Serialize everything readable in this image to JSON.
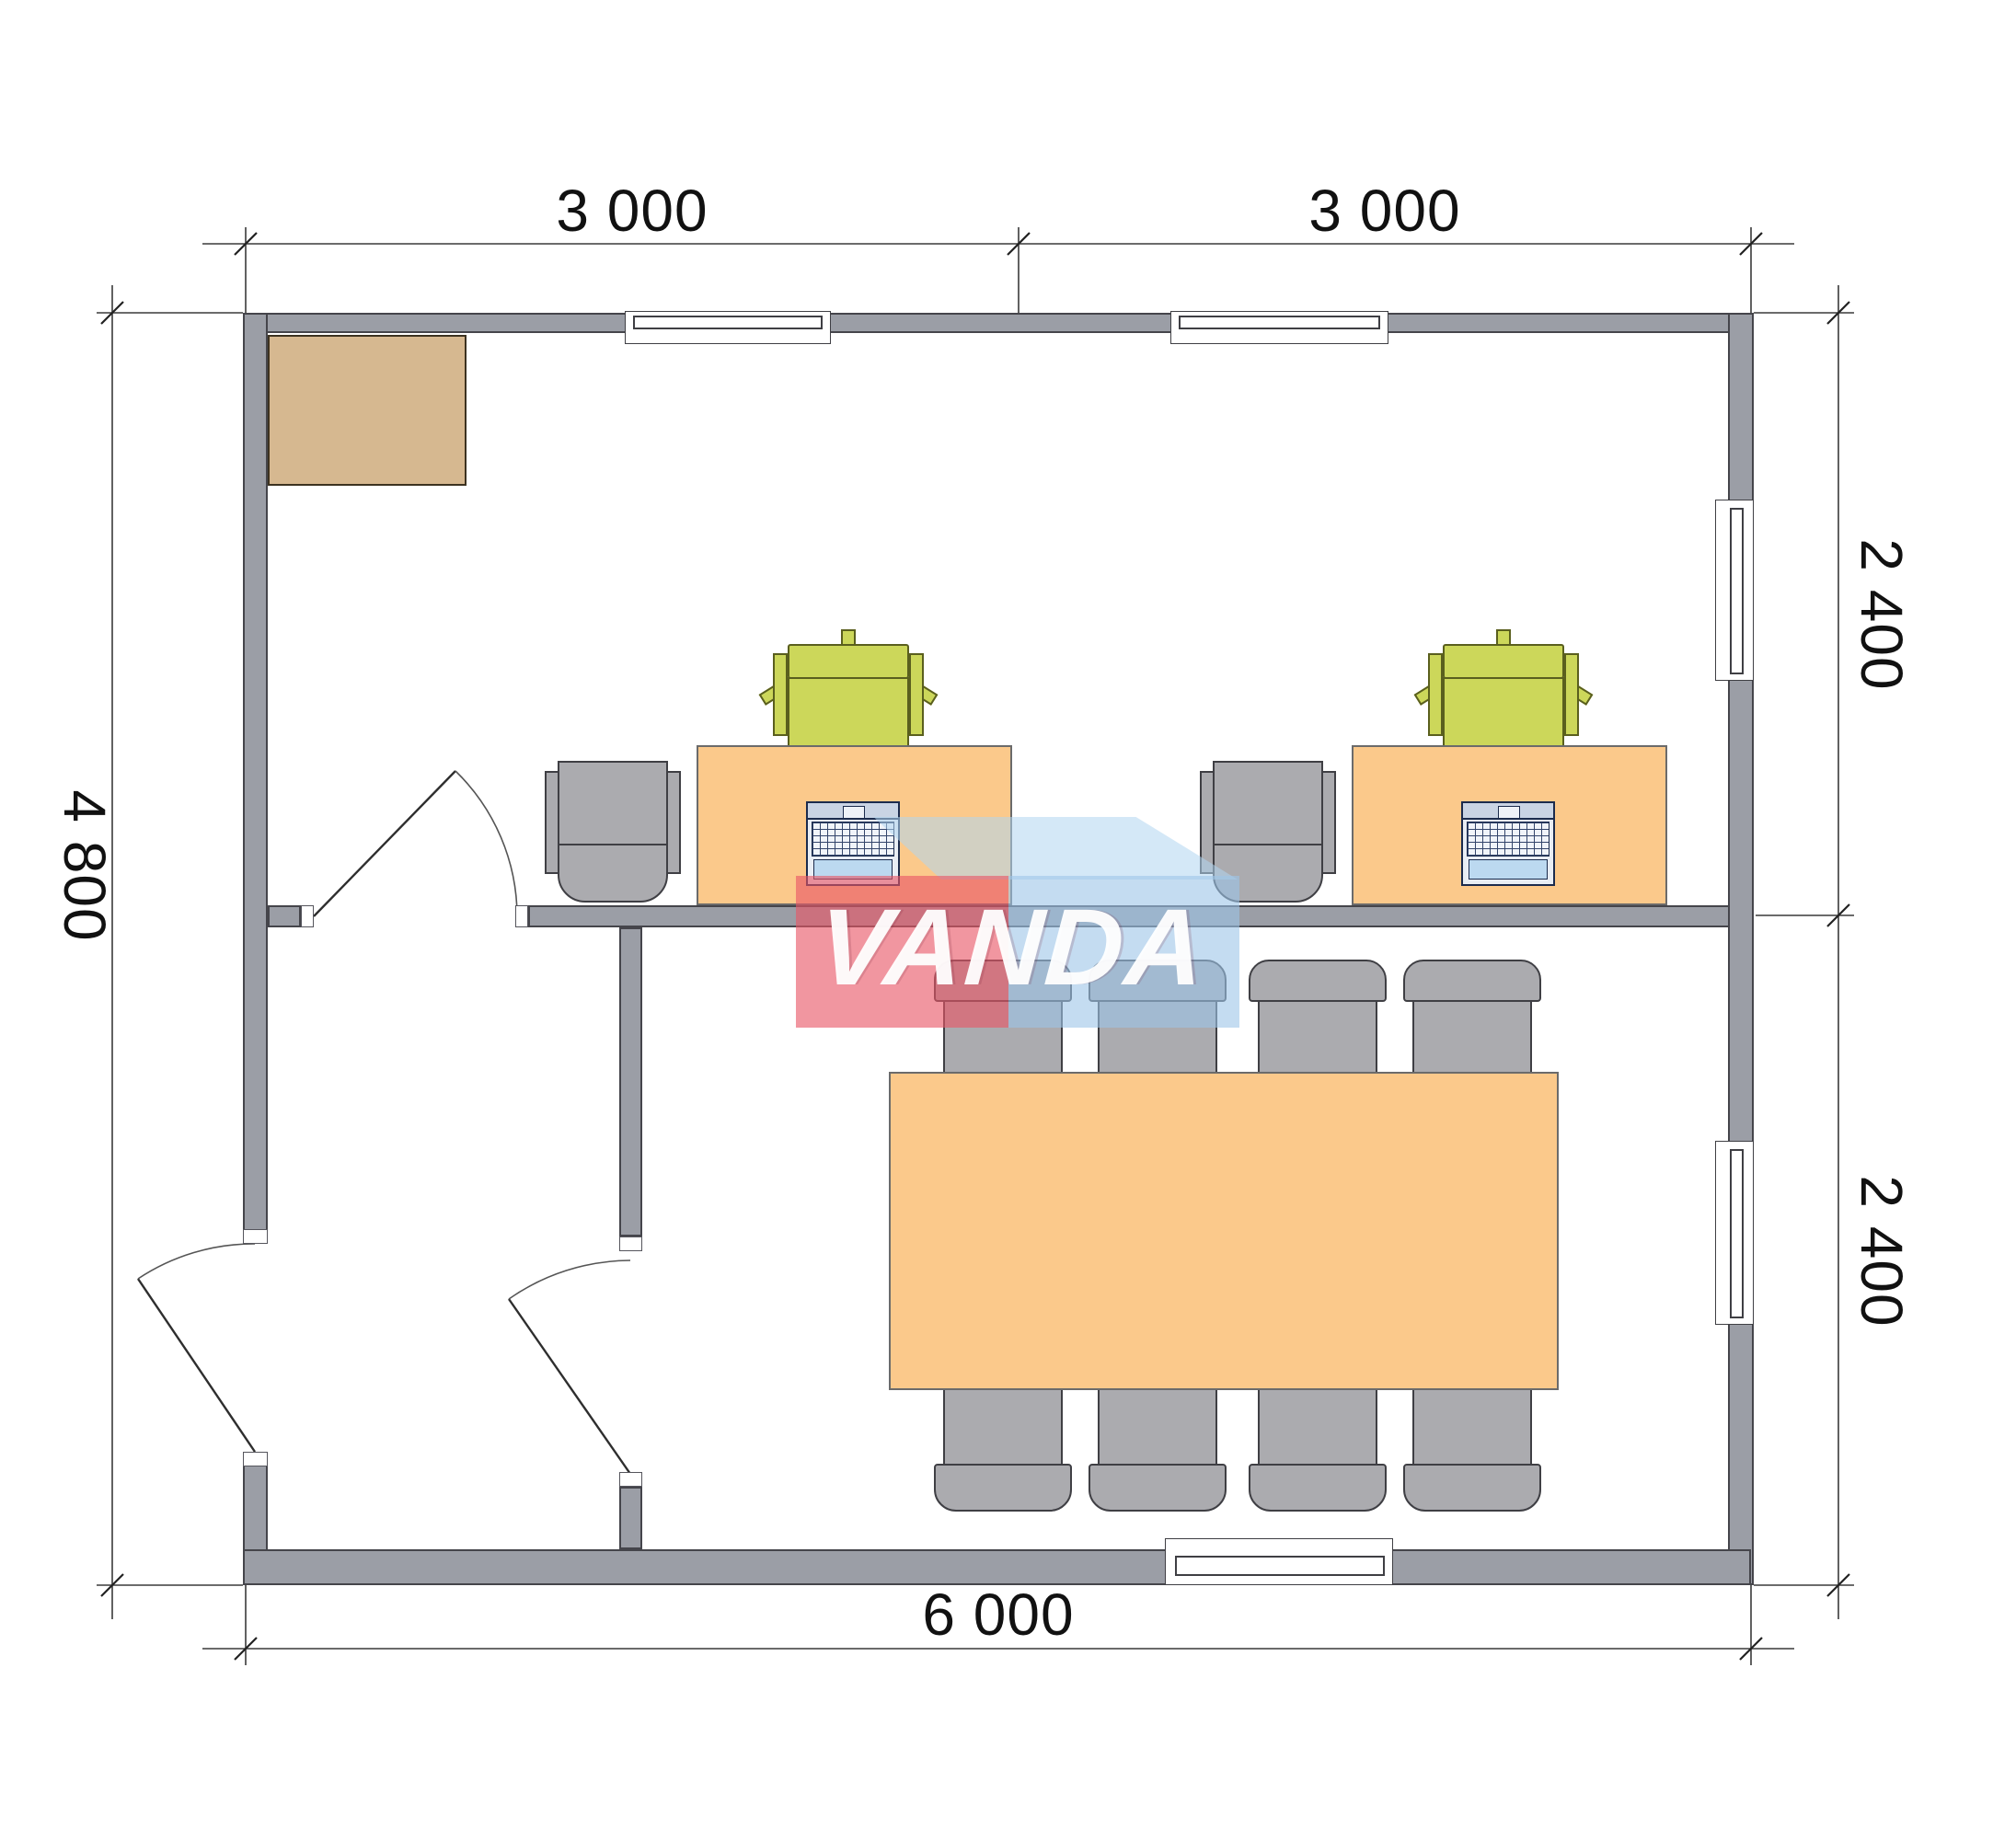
{
  "watermark": {
    "text": "VANDA"
  },
  "dimensions": {
    "top": [
      "3 000",
      "3 000"
    ],
    "right": [
      "2 400",
      "2 400"
    ],
    "left": "4 800",
    "bottom": "6 000"
  },
  "colors": {
    "wall_fill": "#9b9ea6",
    "wall_outline": "#45454b",
    "desk_fill": "#fbc98b",
    "desk_outline": "#6b6b6b",
    "chair_green": "#ccd75a",
    "chair_green_outline": "#5a5f1e",
    "chair_gray": "#ababaf",
    "chair_gray_outline": "#3f3f44",
    "wardrobe_fill": "#d6b890",
    "wardrobe_outline": "#3c3220",
    "laptop_body": "#e8edf4",
    "laptop_accent": "#bcd9f0",
    "laptop_outline": "#1b2b4d",
    "dimension_line": "#3a3a3a",
    "text": "#111111",
    "watermark_pink": "rgba(232,85,102,0.62)",
    "watermark_blue": "rgba(157,197,231,0.60)",
    "watermark_topface": "rgba(176,213,240,0.55)"
  },
  "furniture": {
    "wardrobe_count": 1,
    "workstation_desk_count": 2,
    "office_chair_count": 2,
    "visitor_chair_count": 2,
    "laptop_count": 2,
    "conference_table_count": 1,
    "conference_chair_count": 8,
    "door_count": 3,
    "window_count": 5
  }
}
